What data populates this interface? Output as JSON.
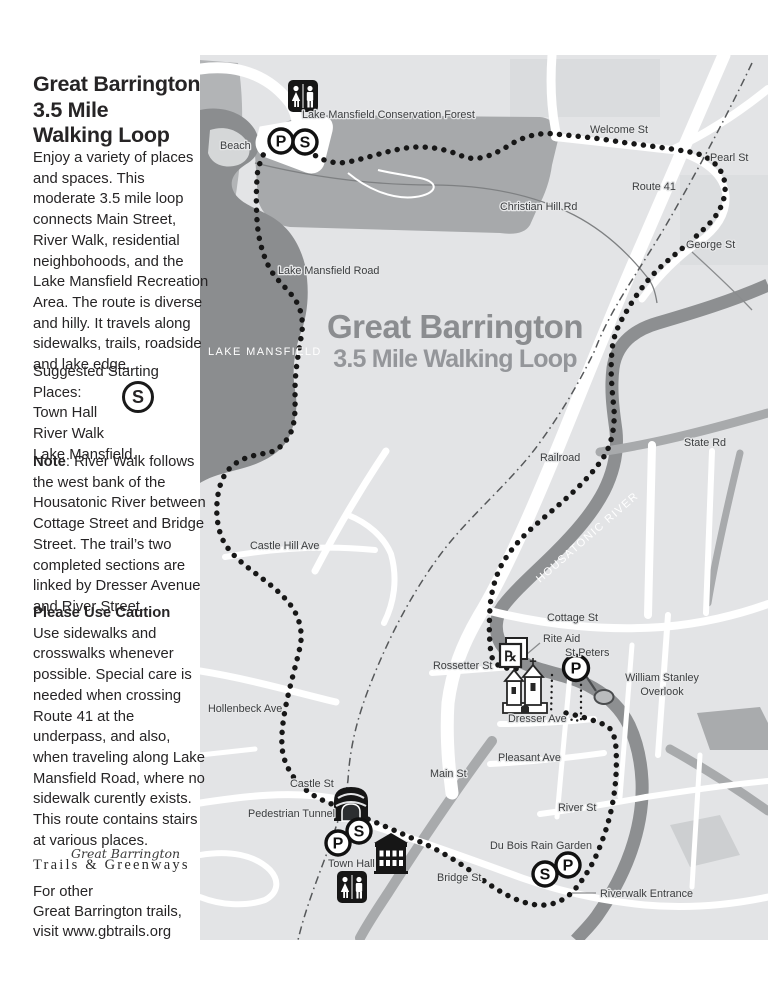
{
  "sidebar": {
    "title": "Great Barrington\n3.5 Mile\nWalking Loop",
    "intro": "Enjoy a variety of places and spaces. This moderate 3.5 mile loop connects Main Street, River Walk, residential neighbohoods, and the Lake Mansfield Recreation Area. The route is diverse and hilly. It travels along sidewalks, trails, roadside and lake edge.",
    "starting_heading": "Suggested Starting Places:",
    "start_1": "Town Hall",
    "start_2": "River Walk",
    "start_3": "Lake Mansfield.",
    "note_label": "Note",
    "note_text": ": River Walk follows the west bank of the Housatonic River between Cottage Street and Bridge Street. The trail’s two completed sections are linked by Dresser Avenue and River Street.",
    "caution_heading": "Please Use Caution",
    "caution_text": "Use sidewalks and crosswalks whenever possible. Special care is needed when crossing Route 41 at the underpass, and also, when traveling along Lake Mansfield Road, where no sidewalk curently exists. This route contains stairs at various places.",
    "logo_script": "Great Barrington",
    "logo_serif": "Trails & Greenways",
    "footer_1": "For other",
    "footer_2": "Great Barrington trails,",
    "footer_3": "visit www.gbtrails.org"
  },
  "map": {
    "title": "Great Barrington",
    "subtitle": "3.5 Mile Walking Loop",
    "markers": {
      "parking": "P",
      "start": "S",
      "pharmacy": "℞"
    },
    "labels": {
      "conservation_forest": "Lake Mansfield Conservation Forest",
      "beach": "Beach",
      "welcome_st": "Welcome St",
      "pearl_st": "Pearl St",
      "route_41": "Route 41",
      "christian_hill_rd": "Christian Hill Rd",
      "george_st": "George St",
      "state_rd": "State Rd",
      "railroad": "Railroad",
      "housatonic_river": "HOUSATONIC RIVER",
      "lake_mansfield": "LAKE MANSFIELD",
      "lake_mansfield_road": "Lake Mansfield Road",
      "castle_hill_ave": "Castle Hill Ave",
      "hollenbeck_ave": "Hollenbeck Ave",
      "cottage_st": "Cottage St",
      "rite_aid": "Rite Aid",
      "st_peters": "St Peters",
      "rossetter_st": "Rossetter St",
      "william_stanley_1": "William Stanley",
      "william_stanley_2": "Overlook",
      "dresser_ave": "Dresser Ave",
      "pleasant_ave": "Pleasant Ave",
      "main_st": "Main St",
      "river_st": "River St",
      "du_bois": "Du Bois Rain Garden",
      "riverwalk_entrance": "Riverwalk Entrance",
      "castle_st": "Castle St",
      "pedestrian_tunnel": "Pedestrian Tunnel",
      "town_hall": "Town Hall",
      "bridge_st": "Bridge St"
    }
  }
}
